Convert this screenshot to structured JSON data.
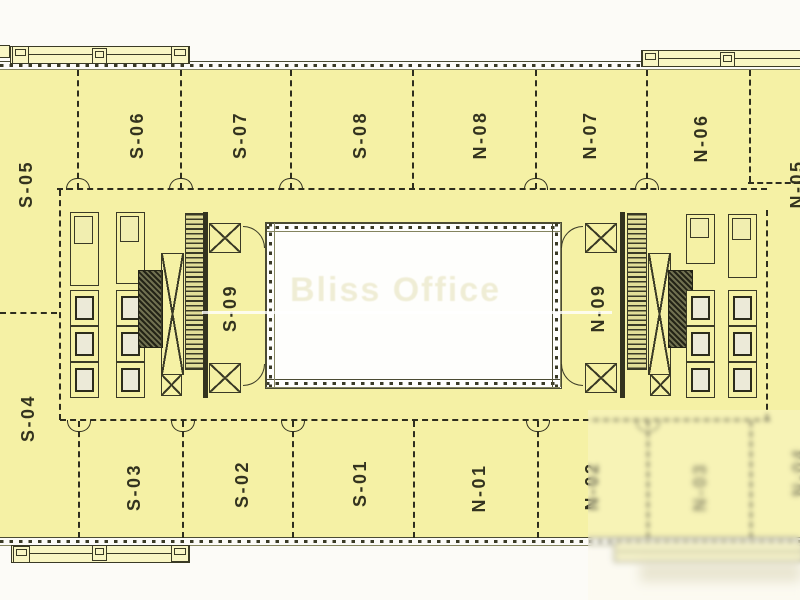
{
  "plan": {
    "title_watermark": "Bliss Office",
    "units": {
      "top": [
        "S-05",
        "S-06",
        "S-07",
        "S-08",
        "N-08",
        "N-07",
        "N-06",
        "N-05"
      ],
      "bottom": [
        "S-04",
        "S-03",
        "S-02",
        "S-01",
        "N-01",
        "N-02",
        "N-03",
        "N-04"
      ],
      "core": [
        "S-09",
        "N-09"
      ]
    },
    "colors": {
      "floor_fill": "#f5f1a5",
      "balcony_fill": "#f9f6c4",
      "line": "#3a3a26",
      "atrium_fill": "#fefefc",
      "page_background": "#fcfbf7"
    }
  }
}
